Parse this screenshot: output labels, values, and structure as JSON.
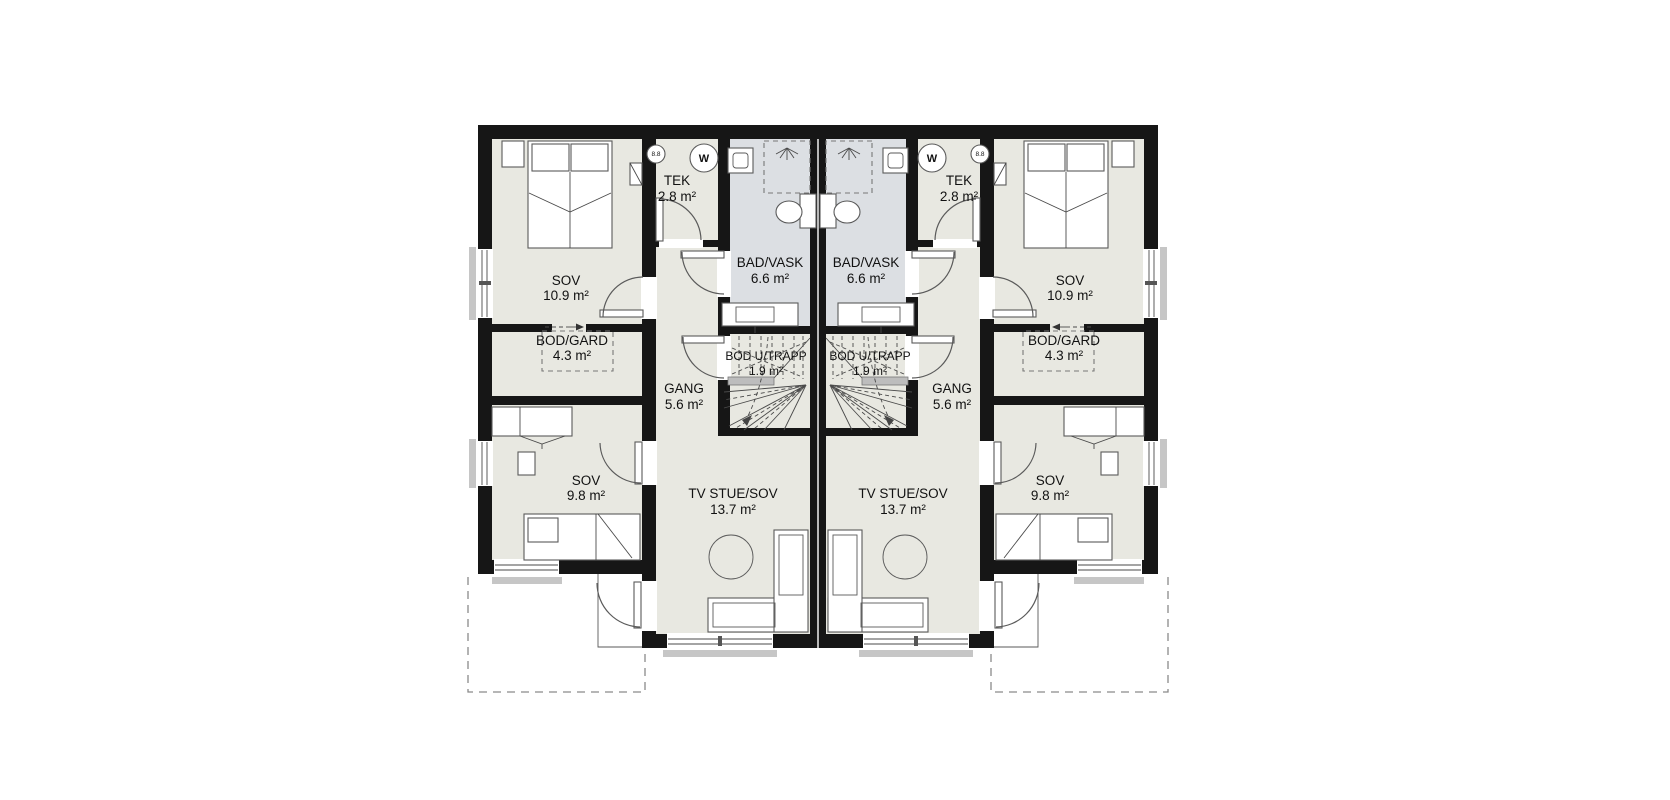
{
  "floor_plan": {
    "rooms": {
      "sov_large": {
        "name": "SOV",
        "area": "10.9 m²"
      },
      "bod_gard": {
        "name": "BOD/GARD",
        "area": "4.3 m²"
      },
      "tek": {
        "name": "TEK",
        "area": "2.8 m²"
      },
      "bad_vask": {
        "name": "BAD/VASK",
        "area": "6.6 m²"
      },
      "bod_u_trapp": {
        "name": "BOD U/TRAPP",
        "area": "1.9 m²"
      },
      "gang": {
        "name": "GANG",
        "area": "5.6 m²"
      },
      "sov_small": {
        "name": "SOV",
        "area": "9.8 m²"
      },
      "tv_stue": {
        "name": "TV STUE/SOV",
        "area": "13.7 m²"
      }
    },
    "fixtures": {
      "washing_machine_label": "W",
      "vent_label": "8.8"
    },
    "colors": {
      "wall": "#161616",
      "floor": "#e8e8e1",
      "bath_floor": "#dcdfe3",
      "furniture_line": "#5a5a5a",
      "sill": "#c6c6c6",
      "terrace_dash": "#8a8a8a"
    }
  }
}
